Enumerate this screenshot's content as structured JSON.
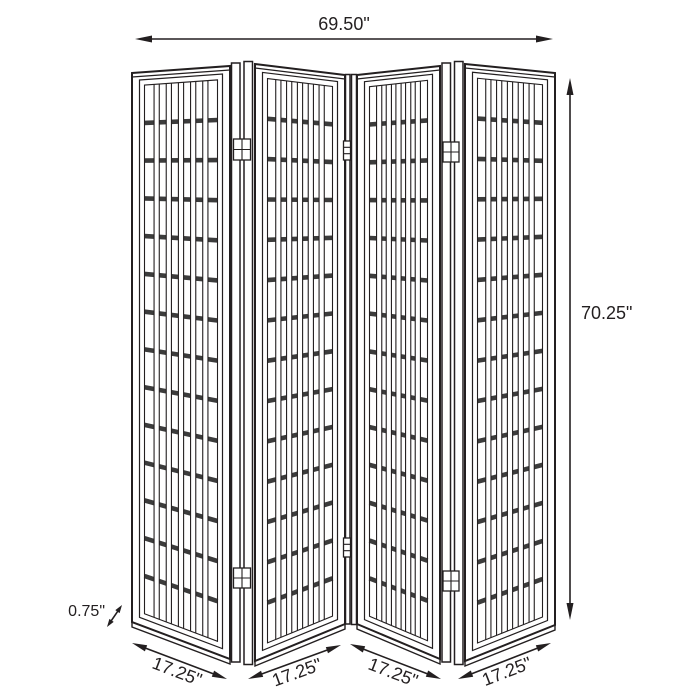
{
  "diagram": {
    "subject": "four-panel folding screen room divider",
    "panel_count": 4,
    "colors": {
      "line": "#231f20",
      "rail_fill": "#3c3c3c",
      "panel_fill": "#ffffff",
      "background": "#ffffff"
    },
    "dimensions": {
      "overall_width": {
        "label": "69.50\""
      },
      "overall_height": {
        "label": "70.25\""
      },
      "panel_thickness": {
        "label": "0.75\""
      },
      "panel_widths": [
        {
          "panel": 1,
          "label": "17.25\""
        },
        {
          "panel": 2,
          "label": "17.25\""
        },
        {
          "panel": 3,
          "label": "17.25\""
        },
        {
          "panel": 4,
          "label": "17.25\""
        }
      ]
    }
  }
}
